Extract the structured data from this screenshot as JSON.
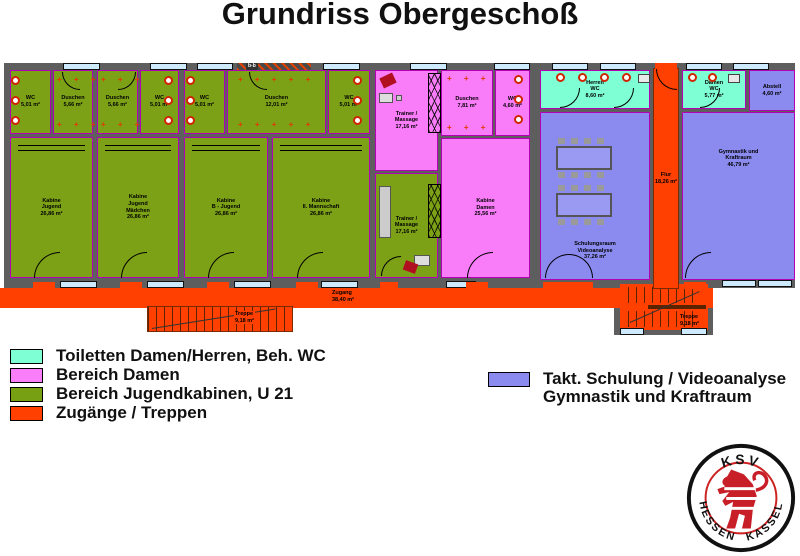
{
  "title": "Grundriss Obergeschoß",
  "section_marker": "b-b",
  "legend": {
    "left": [
      {
        "label": "Toiletten Damen/Herren, Beh. WC",
        "color": "#7fffd4"
      },
      {
        "label": "Bereich Damen",
        "color": "#fa7dfa"
      },
      {
        "label": "Bereich Jugendkabinen, U 21",
        "color": "#77a012"
      },
      {
        "label": "Zugänge / Treppen",
        "color": "#ff4000"
      }
    ],
    "right": {
      "color": "#8a8aef",
      "line1": "Takt. Schulung / Videoanalyse",
      "line2": "Gymnastik und Kraftraum"
    }
  },
  "rooms": {
    "wc1": {
      "label": "WC\n5,01 m²"
    },
    "du1": {
      "label": "Duschen\n5,66 m²"
    },
    "du2": {
      "label": "Duschen\n5,66 m²"
    },
    "wc2": {
      "label": "WC\n5,01 m²"
    },
    "wc3": {
      "label": "WC\n5,01 m²"
    },
    "du3": {
      "label": "Duschen\n12,01 m²"
    },
    "wc4": {
      "label": "WC\n5,01 m²"
    },
    "k1": {
      "label": "Kabine\nJugend\n26,86 m²"
    },
    "k2": {
      "label": "Kabine\nJugend\nMädchen\n26,86 m²"
    },
    "k3": {
      "label": "Kabine\nB - Jugend\n26,86 m²"
    },
    "k4": {
      "label": "Kabine\nII. Mannschaft\n26,86 m²"
    },
    "trainer_o": {
      "label": "Trainer /\nMassage\n17,16 m²"
    },
    "trainer_u": {
      "label": "Trainer /\nMassage\n17,16 m²"
    },
    "du_d": {
      "label": "Duschen\n7,81 m²"
    },
    "wc_d": {
      "label": "WC\n4,60 m²"
    },
    "kab_d": {
      "label": "Kabine\nDamen\n25,56 m²"
    },
    "herren_wc": {
      "label": "Herren\nWC\n8,60 m²"
    },
    "damen_wc": {
      "label": "Damen\nWC\n5,77 m²"
    },
    "abstell": {
      "label": "Abstell\n4,60 m²"
    },
    "schulung": {
      "label": "Schulungsraum\nVideoanalyse\n37,26 m²"
    },
    "gym": {
      "label": "Gymnastik und\nKraftraum\n46,79 m²"
    },
    "flur": {
      "label": "Flur\n18,26 m²"
    },
    "zugang": {
      "label": "Zugang\n38,40 m²"
    },
    "treppe_l": {
      "label": "Treppe\n9,18 m²"
    },
    "treppe_r": {
      "label": "Treppe\n9,18 m²"
    }
  },
  "logo": {
    "top": "KSV",
    "bottom_left": "HESSEN",
    "bottom_right": "KASSEL"
  }
}
